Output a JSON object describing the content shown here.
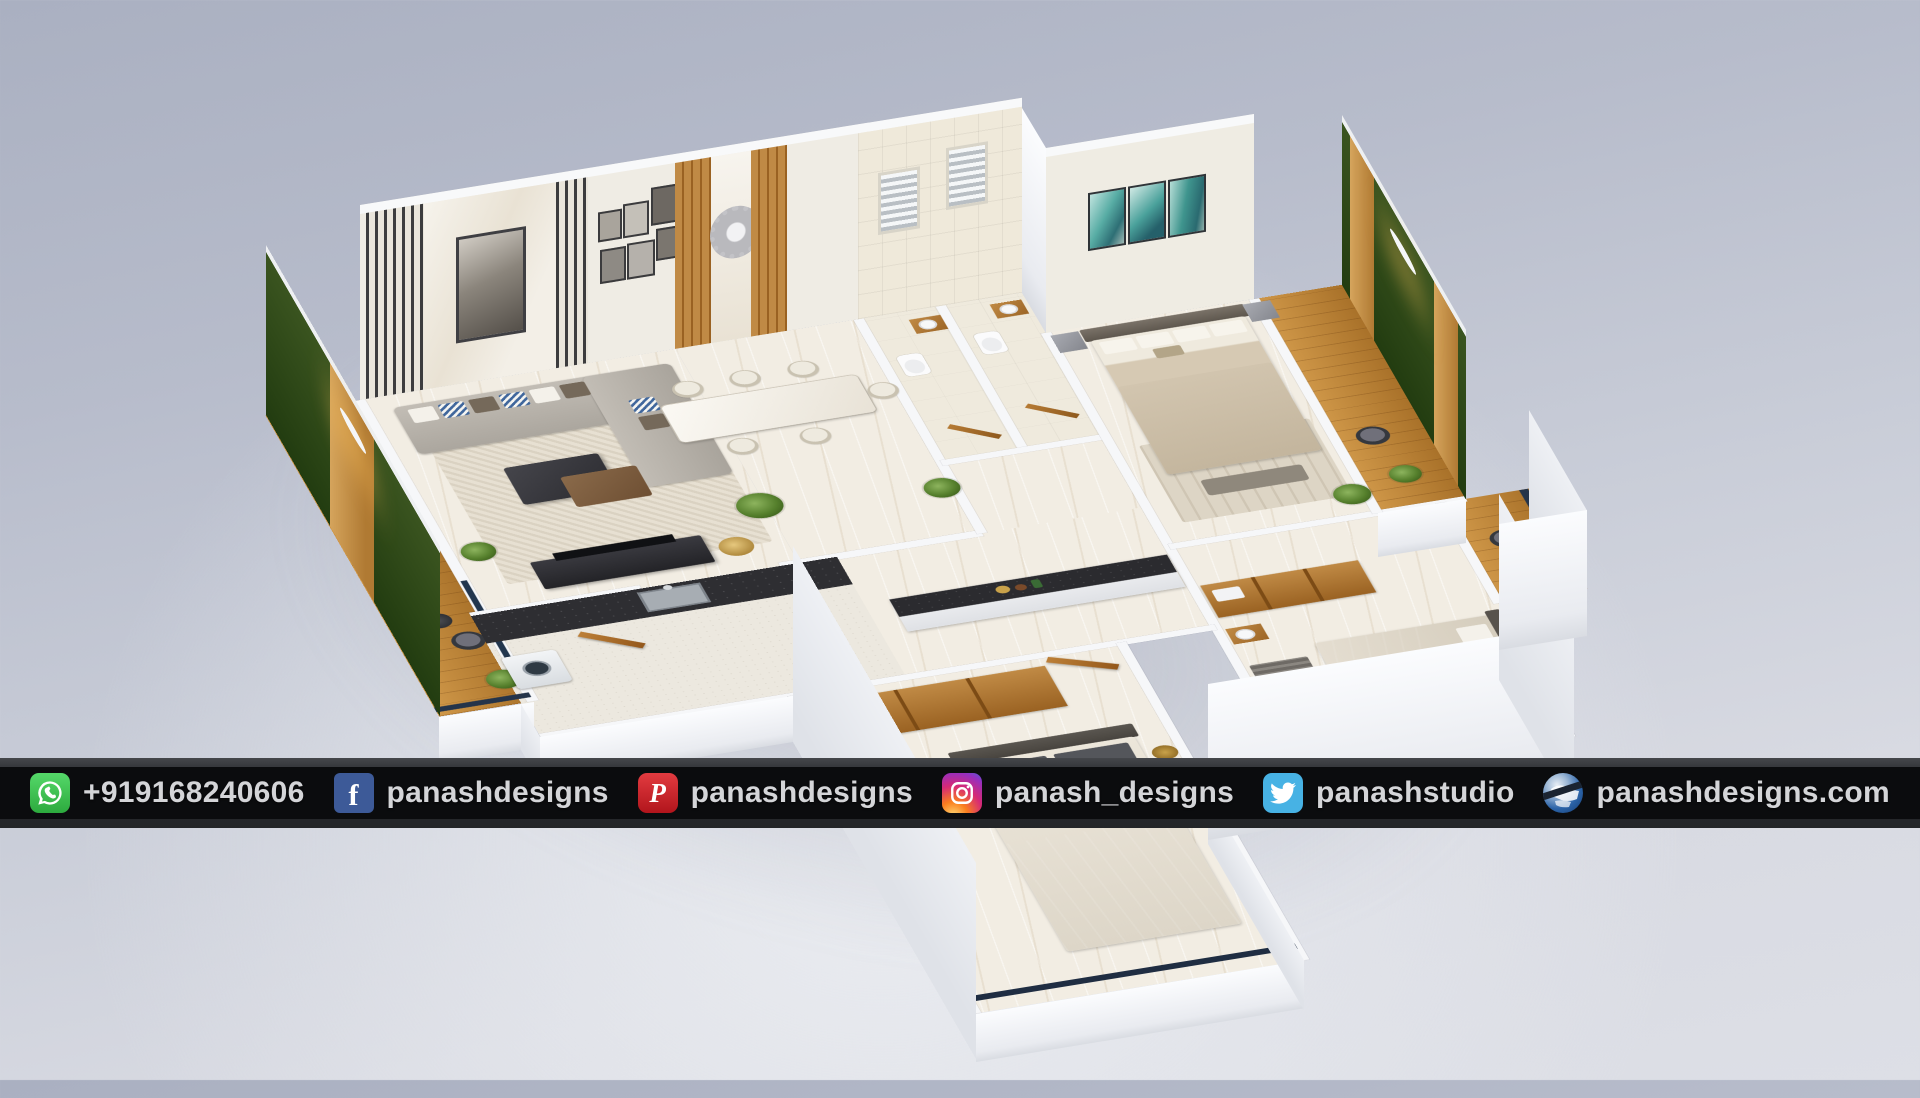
{
  "banner": {
    "items": [
      {
        "icon": "whatsapp-icon",
        "label": "+919168240606"
      },
      {
        "icon": "facebook-icon",
        "label": "panashdesigns"
      },
      {
        "icon": "pinterest-icon",
        "label": "panashdesigns"
      },
      {
        "icon": "instagram-icon",
        "label": "panash_designs"
      },
      {
        "icon": "twitter-icon",
        "label": "panashstudio"
      },
      {
        "icon": "website-icon",
        "label": "panashdesigns.com"
      }
    ],
    "colors": {
      "bar_outer": "#303236",
      "bar_inner": "#0b0c0e",
      "text": "#d4d5d8",
      "whatsapp_green": "#3fc351",
      "facebook_blue": "#3d5a98",
      "pinterest_red": "#cb1f27",
      "twitter_blue": "#47b2e4",
      "instagram_gradient": [
        "#feda75",
        "#fa7e1e",
        "#d62976",
        "#962fbf"
      ],
      "website_globe_blue": "#2b63a8"
    }
  },
  "scene": {
    "subject": "3D isometric floor plan render of an apartment",
    "background_top": "#aab0c1",
    "background_bottom": "#dddfe6",
    "palette": {
      "exterior_walls": "#f2f3f5",
      "interior_wall_cream": "#efece3",
      "marble_floor": "#f2ede3",
      "wood_accent": "#b97a35",
      "vertical_garden_green": "#33511d",
      "kitchen_counter_black": "#2e2e32",
      "sofa_gray": "#b6b1a9",
      "master_bed_beige": "#cfc2ae",
      "artwork_teal": "#57aca4",
      "balcony_wood": "#c0812f"
    }
  }
}
